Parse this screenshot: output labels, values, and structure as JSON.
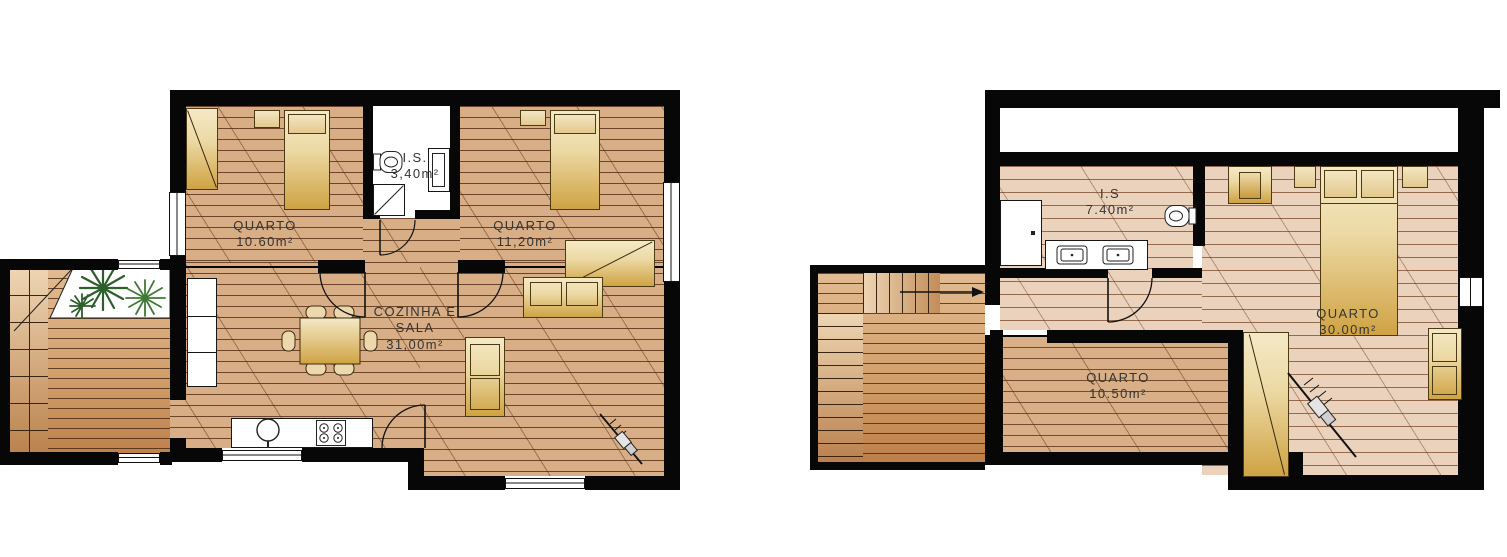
{
  "document": {
    "title": "House floor plans",
    "type": "architectural floor plan drawing",
    "background": "#ffffff"
  },
  "colors": {
    "wall": "#070707",
    "wood_floor": "#d8ae87",
    "wood_floor_light": "#ebd2bc",
    "wood_floor_mid": "#d9af87",
    "deck_dark": "#bd7f4a",
    "furniture_light": "#f5e9c6",
    "furniture_dark": "#cfa343",
    "plant_green": "#2d5f2b",
    "label_text": "#343434"
  },
  "plans": [
    {
      "name": "ground-floor-plan",
      "rooms": [
        {
          "id": "quarto-1",
          "label": "QUARTO",
          "area": "10.60m²"
        },
        {
          "id": "bathroom",
          "label": "I.S.",
          "area": "3,40m²"
        },
        {
          "id": "quarto-2",
          "label": "QUARTO",
          "area": "11,20m²"
        },
        {
          "id": "living-kitchen",
          "label": "COZINHA E",
          "label_line2": "SALA",
          "area": "31,00m²"
        }
      ],
      "features": [
        "staircase",
        "planted-terrace",
        "kitchen-counter",
        "sink",
        "stove",
        "dining-table",
        "sofas",
        "beds",
        "wardrobes",
        "toilet",
        "shower",
        "vanity"
      ]
    },
    {
      "name": "upper-floor-plan",
      "rooms": [
        {
          "id": "bathroom",
          "label": "I.S",
          "area": "7.40m²"
        },
        {
          "id": "quarto-3",
          "label": "QUARTO",
          "area": "30.00m²"
        },
        {
          "id": "quarto-4",
          "label": "QUARTO",
          "area": "10.50m²"
        }
      ],
      "features": [
        "staircase",
        "terrace",
        "double-bed",
        "wardrobes",
        "double-vanity",
        "toilet",
        "shower",
        "sofa"
      ]
    }
  ]
}
